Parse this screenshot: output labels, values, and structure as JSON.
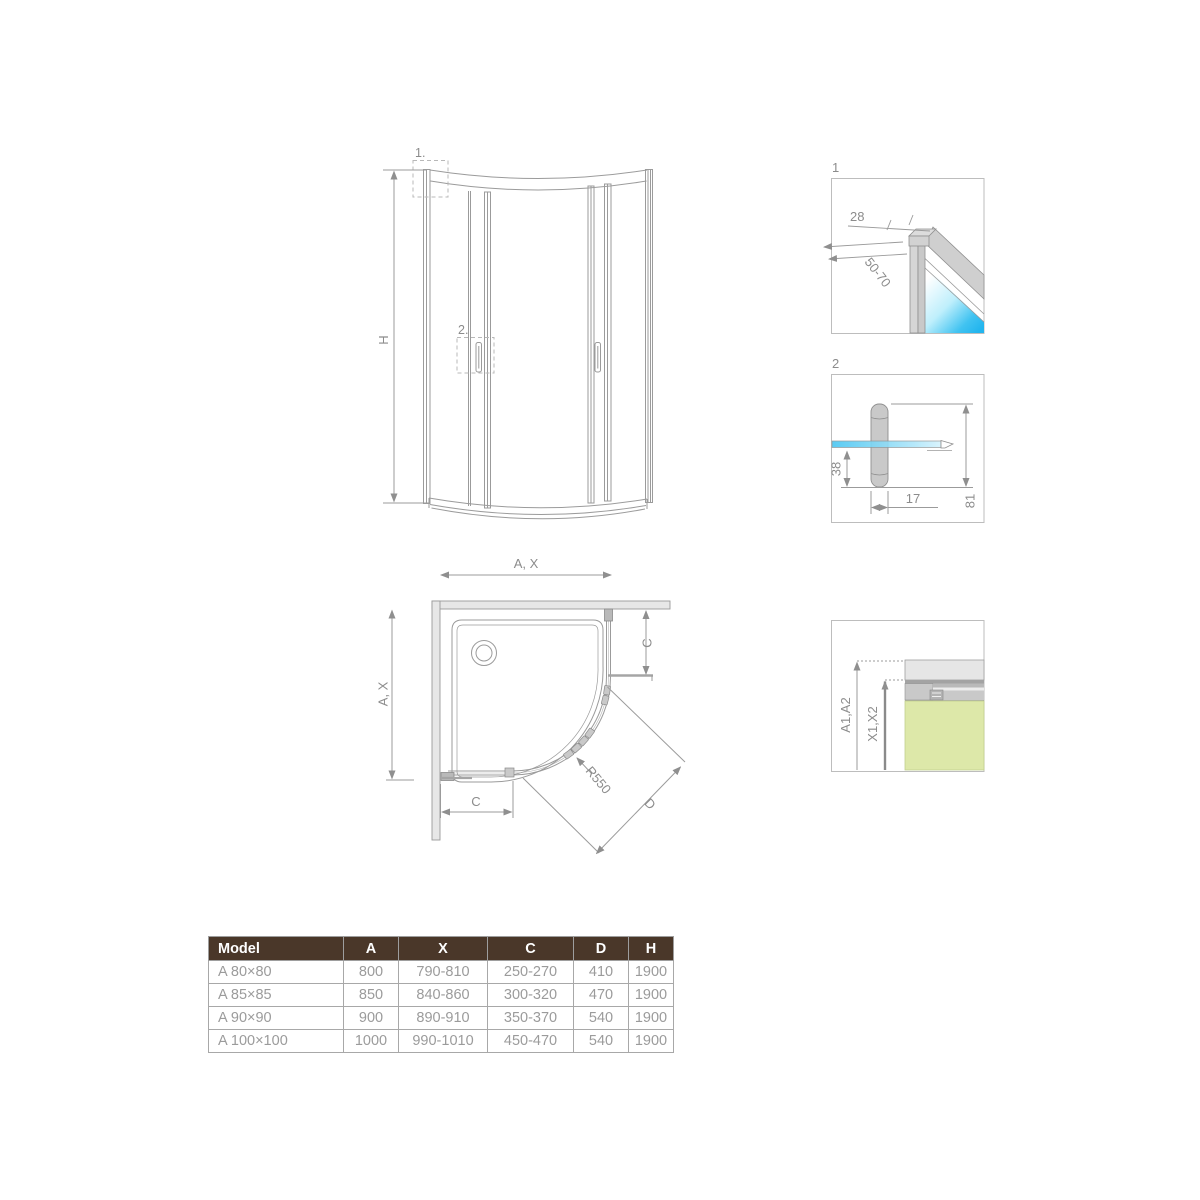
{
  "colors": {
    "line": "#9b9b9b",
    "text": "#8c8c8c",
    "glass_blue": "#3ec1f0",
    "glass_green": "#dde8a9",
    "wall_fill": "#e7e7e7",
    "profile_fill": "#cdcdcd",
    "table_header_bg": "#4a3729",
    "table_header_text": "#ffffff",
    "table_body_text": "#9b9b9b"
  },
  "elevation": {
    "marker1": "1.",
    "marker2": "2.",
    "dim_height": "H",
    "dim_width": "A, X"
  },
  "plan": {
    "dim_width_left": "A, X",
    "dim_c_right": "C",
    "dim_c_bottom": "C",
    "radius_label": "R550",
    "dim_d": "D"
  },
  "details": {
    "d1": {
      "label": "1",
      "dim_top": "28",
      "dim_range": "50-70"
    },
    "d2": {
      "label": "2",
      "dim_height": "38",
      "dim_width": "17",
      "dim_total": "81"
    },
    "d3": {
      "dim_outer": "A1,A2",
      "dim_inner": "X1,X2"
    }
  },
  "table": {
    "headers": [
      "Model",
      "A",
      "X",
      "C",
      "D",
      "H"
    ],
    "rows": [
      [
        "A 80×80",
        "800",
        "790-810",
        "250-270",
        "410",
        "1900"
      ],
      [
        "A 85×85",
        "850",
        "840-860",
        "300-320",
        "470",
        "1900"
      ],
      [
        "A 90×90",
        "900",
        "890-910",
        "350-370",
        "540",
        "1900"
      ],
      [
        "A 100×100",
        "1000",
        "990-1010",
        "450-470",
        "540",
        "1900"
      ]
    ]
  }
}
